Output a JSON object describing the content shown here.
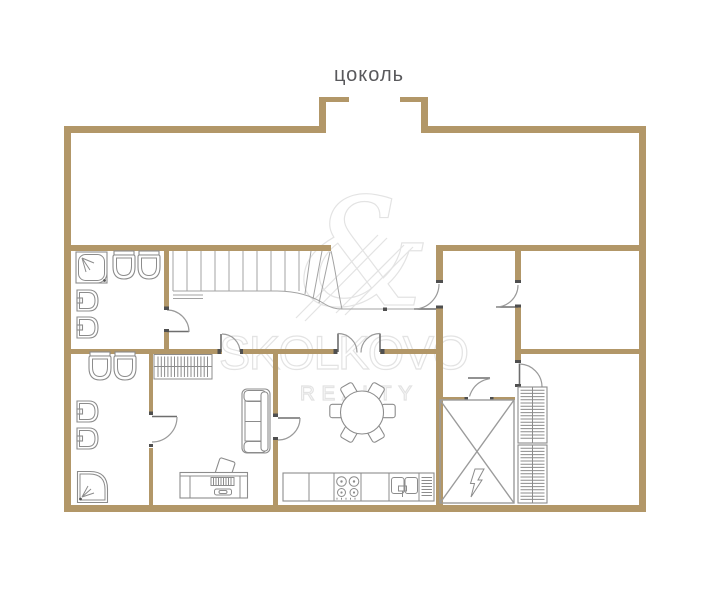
{
  "title": "цоколь",
  "watermark": {
    "symbol": "&",
    "name": "SKOLKOVO",
    "subtitle": "REALTY"
  },
  "colors": {
    "wall": "#b29768",
    "fixtures": "#8c8c8c",
    "stairs": "#a3a3a3",
    "watermark": "#e3e3e3",
    "title": "#59595c"
  }
}
